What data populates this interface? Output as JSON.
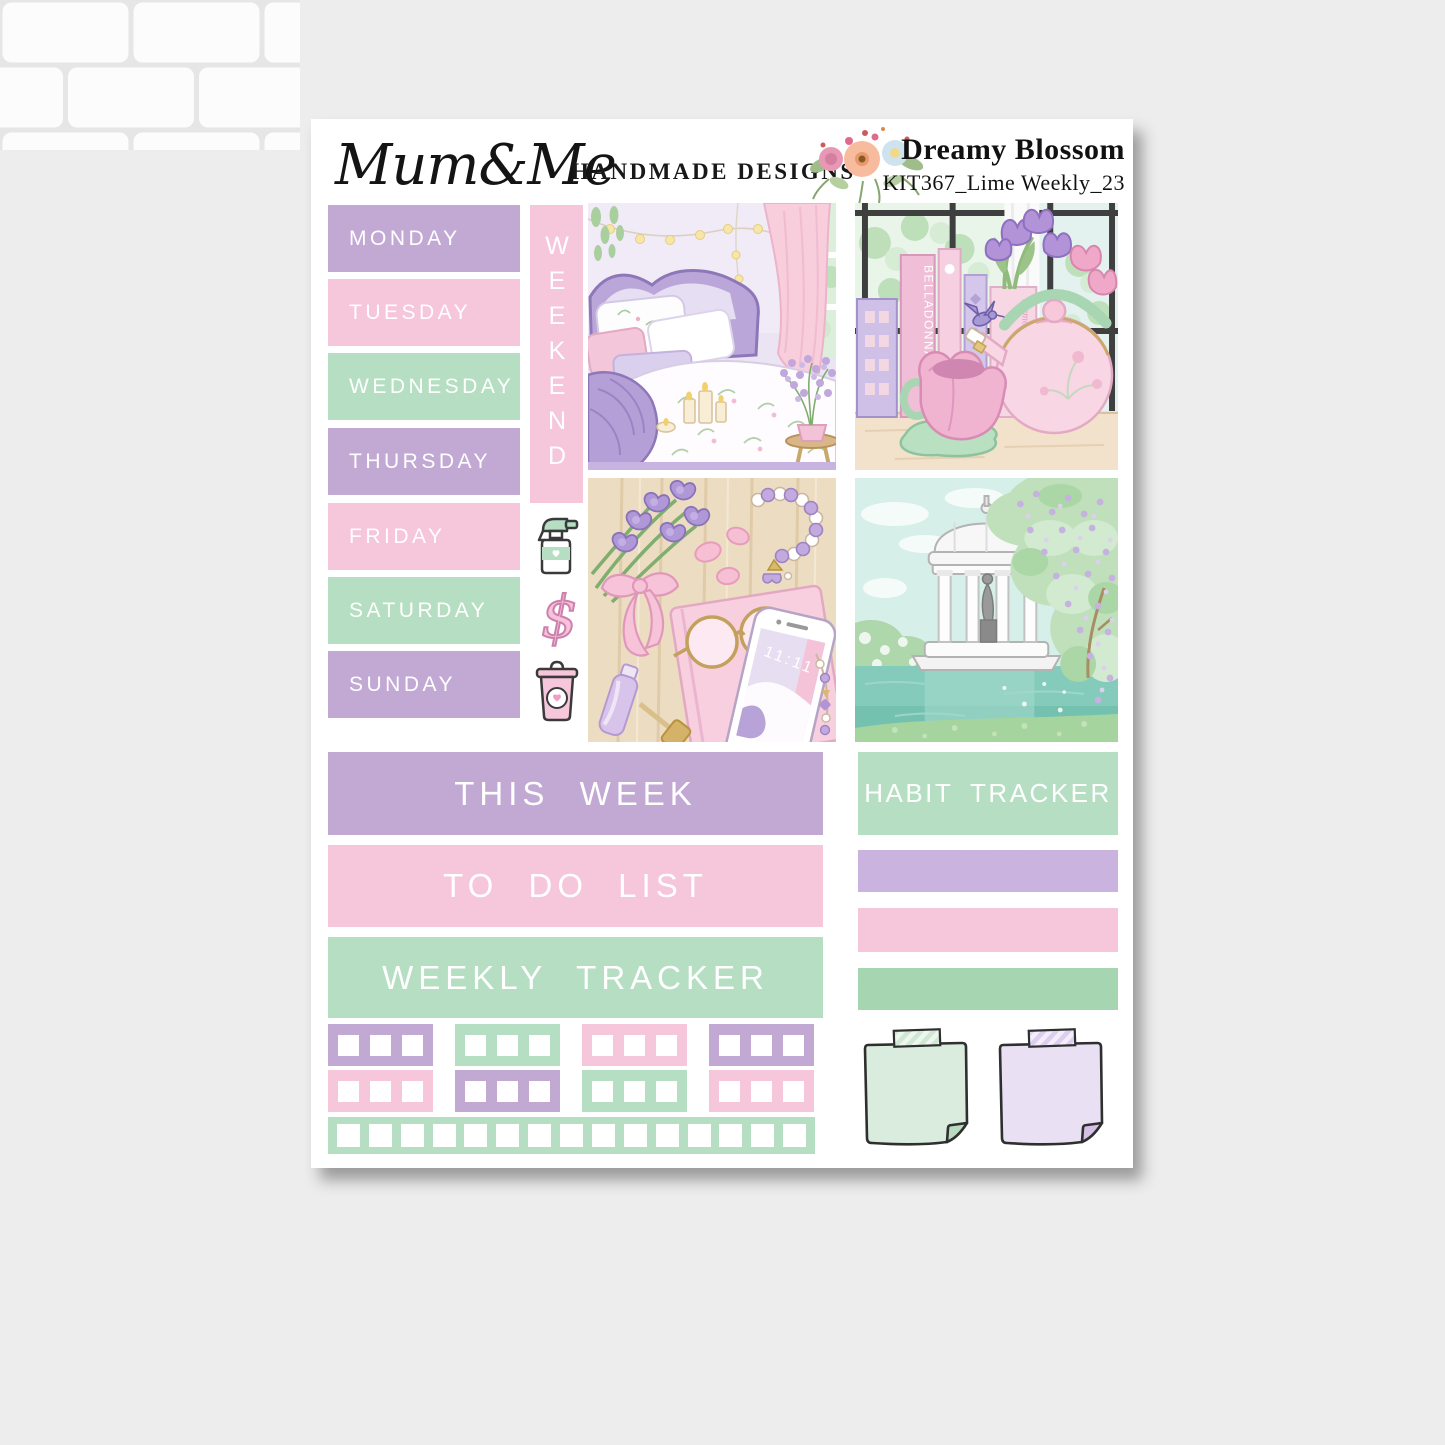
{
  "brand": {
    "logo": "Mum&Me",
    "tagline": "HANDMADE DESIGNS"
  },
  "kit": {
    "name": "Dreamy Blossom",
    "code": "KIT367_Lime Weekly_23"
  },
  "days": [
    {
      "label": "MONDAY",
      "color": "purple"
    },
    {
      "label": "TUESDAY",
      "color": "pink"
    },
    {
      "label": "WEDNESDAY",
      "color": "green"
    },
    {
      "label": "THURSDAY",
      "color": "purple"
    },
    {
      "label": "FRIDAY",
      "color": "pink"
    },
    {
      "label": "SATURDAY",
      "color": "green"
    },
    {
      "label": "SUNDAY",
      "color": "purple"
    }
  ],
  "weekend": {
    "label": "WEEKEND",
    "color": "pink"
  },
  "section_headers": {
    "this_week": "THIS WEEK",
    "to_do_list": "TO DO LIST",
    "weekly_tracker": "WEEKLY TRACKER",
    "habit_tracker": "HABIT TRACKER"
  },
  "icons": {
    "spray_bottle": "spray-bottle",
    "dollar_sign": "dollar-sign",
    "dollar_glyph": "$",
    "trash_can": "trash-can",
    "floral_bouquet": "floral-bouquet"
  },
  "illustration_text": {
    "book_spine": "BELLADONNA",
    "book_box": "Memories of",
    "phone_time": "11:11"
  },
  "grid": {
    "row1": [
      "purple",
      "green",
      "pink",
      "purple"
    ],
    "row2": [
      "pink",
      "purple",
      "green",
      "pink"
    ],
    "boxes_per_block": 3,
    "strip_color": "green",
    "strip_boxes": 15
  },
  "brushes": [
    "brush-purple",
    "pink",
    "green-dark"
  ],
  "notes": [
    {
      "color": "green"
    },
    {
      "color": "lilac"
    }
  ],
  "palette": {
    "purple": "#c2a9d3",
    "pink": "#f6c6db",
    "green": "#b6dec2",
    "green-dark": "#a6d5b2",
    "brush-purple": "#cab3de",
    "sheet": "#ffffff",
    "grout": "#e6e6e6",
    "tile": "#fcfcfc",
    "outline": "#3a3a3a",
    "note-green": "#d9ecdd",
    "note-green-fold": "#b9dcc1",
    "note-lilac": "#eae0f3",
    "note-lilac-fold": "#d4c0e5"
  }
}
